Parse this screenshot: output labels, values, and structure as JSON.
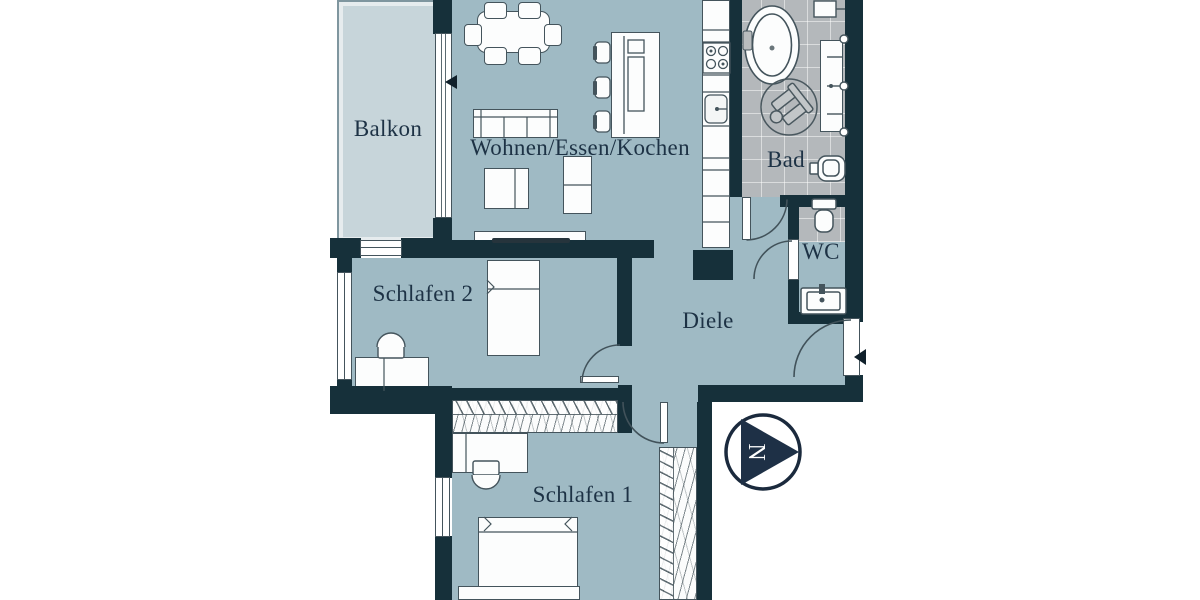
{
  "plan": {
    "rooms": [
      {
        "id": "balkon",
        "label": "Balkon"
      },
      {
        "id": "wohnen_essen_kochen",
        "label": "Wohnen/Essen/Kochen"
      },
      {
        "id": "bad",
        "label": "Bad"
      },
      {
        "id": "wc",
        "label": "WC"
      },
      {
        "id": "diele",
        "label": "Diele"
      },
      {
        "id": "schlafen_2",
        "label": "Schlafen 2"
      },
      {
        "id": "schlafen_1",
        "label": "Schlafen 1"
      }
    ],
    "compass": {
      "label": "N",
      "points": "east"
    },
    "markers": {
      "entrance_arrow": "points-left",
      "balcony_door_arrow": "points-left"
    },
    "colors": {
      "room_fill": "#9fbac4",
      "balcony_fill": "#c7d5da",
      "wall": "#16303a",
      "tile": "#b4b8bb",
      "label": "#1d3245",
      "furniture_line": "#44545c",
      "furniture_fill": "#fcfdfd",
      "north_arrow": "#1e3046"
    }
  }
}
